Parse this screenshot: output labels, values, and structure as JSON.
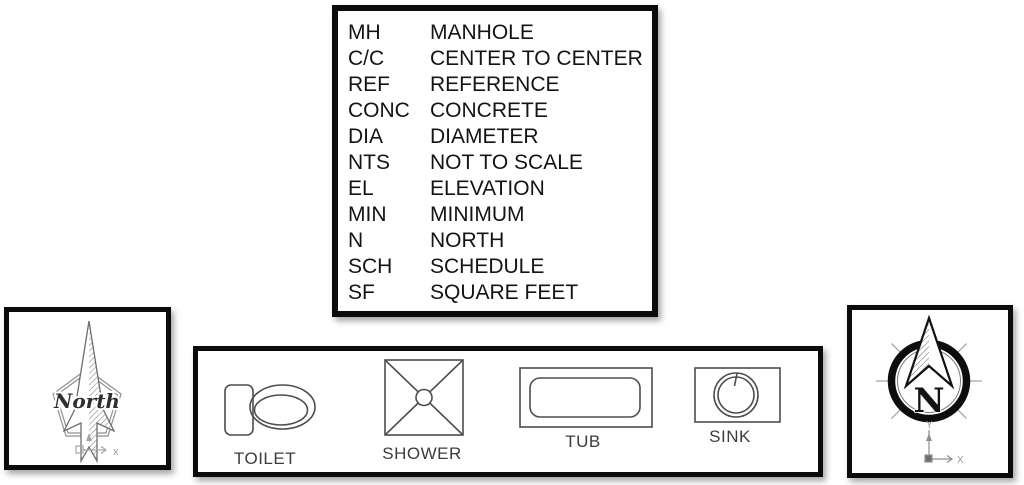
{
  "legend": {
    "rows": [
      {
        "code": "MH",
        "definition": "MANHOLE"
      },
      {
        "code": "C/C",
        "definition": "CENTER TO CENTER"
      },
      {
        "code": "REF",
        "definition": "REFERENCE"
      },
      {
        "code": "CONC",
        "definition": "CONCRETE"
      },
      {
        "code": "DIA",
        "definition": "DIAMETER"
      },
      {
        "code": "NTS",
        "definition": "NOT TO SCALE"
      },
      {
        "code": "EL",
        "definition": "ELEVATION"
      },
      {
        "code": "MIN",
        "definition": "MINIMUM"
      },
      {
        "code": "N",
        "definition": "NORTH"
      },
      {
        "code": "SCH",
        "definition": "SCHEDULE"
      },
      {
        "code": "SF",
        "definition": "SQUARE FEET"
      }
    ]
  },
  "north_symbol": {
    "label": "North",
    "axis_x_label": "x",
    "icon": "north-arrow-pentagon-icon"
  },
  "compass_symbol": {
    "label": "N",
    "axis_x_label": "X",
    "axis_y_label": "Y",
    "icon": "compass-north-arrow-icon"
  },
  "fixtures": {
    "items": [
      {
        "label": "TOILET",
        "icon": "toilet-icon"
      },
      {
        "label": "SHOWER",
        "icon": "shower-icon"
      },
      {
        "label": "TUB",
        "icon": "tub-icon"
      },
      {
        "label": "SINK",
        "icon": "sink-icon"
      }
    ]
  },
  "colors": {
    "background": "#ffffff",
    "panel_border": "#0b0b0b",
    "text": "#141414",
    "drawing_line": "#4d4d4d",
    "light_line": "#8a8a8a",
    "axis_line": "#9b9b9b"
  }
}
